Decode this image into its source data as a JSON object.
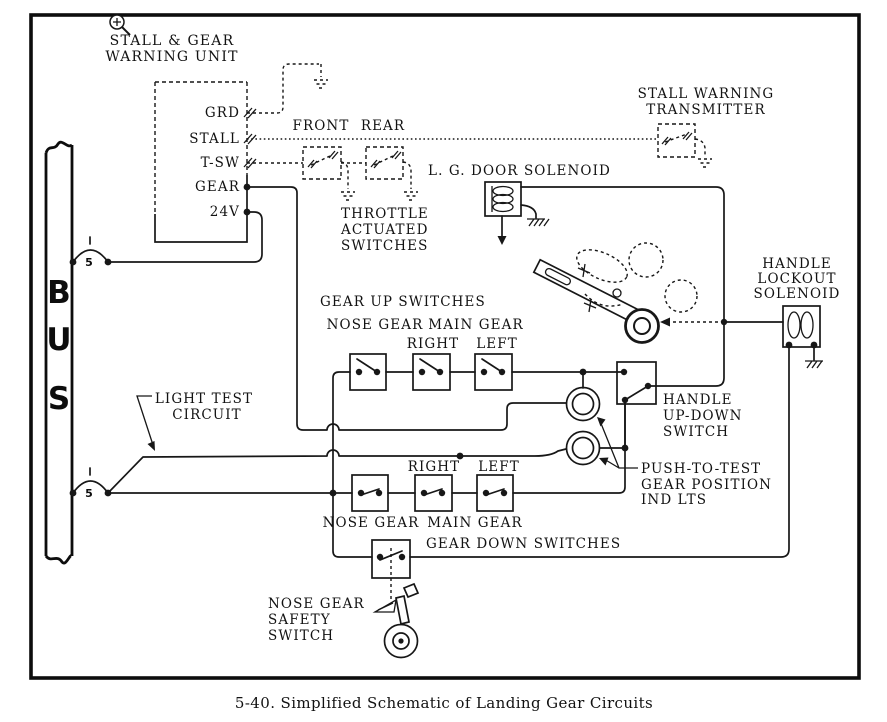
{
  "figure": {
    "caption": "5-40.  Simplified Schematic of Landing Gear Circuits"
  },
  "icons": {
    "magnifier": "circled-plus-with-handle"
  },
  "bus": {
    "name_letters": [
      "B",
      "U",
      "S"
    ],
    "breakers": [
      {
        "rating": "5"
      },
      {
        "rating": "5"
      }
    ]
  },
  "warning_unit": {
    "title": [
      "STALL & GEAR",
      "WARNING UNIT"
    ],
    "terminals": [
      "GRD",
      "STALL",
      "T-SW",
      "GEAR",
      "24V"
    ]
  },
  "throttle_switches": {
    "front_label": "FRONT",
    "rear_label": "REAR",
    "caption": [
      "THROTTLE",
      "ACTUATED",
      "SWITCHES"
    ]
  },
  "stall_transmitter": {
    "label": [
      "STALL WARNING",
      "TRANSMITTER"
    ]
  },
  "door_solenoid": {
    "label": "L. G. DOOR SOLENOID"
  },
  "handle_lockout": {
    "label": [
      "HANDLE",
      "LOCKOUT",
      "SOLENOID"
    ]
  },
  "handle_switch": {
    "label": [
      "HANDLE",
      "UP-DOWN",
      "SWITCH"
    ]
  },
  "gear_up": {
    "title": "GEAR UP SWITCHES",
    "nose": "NOSE GEAR",
    "main": "MAIN GEAR",
    "right": "RIGHT",
    "left": "LEFT"
  },
  "gear_down": {
    "title": "GEAR DOWN SWITCHES",
    "nose": "NOSE GEAR",
    "main": "MAIN GEAR",
    "right": "RIGHT",
    "left": "LEFT"
  },
  "indicator_lights": {
    "label": [
      "PUSH-TO-TEST",
      "GEAR POSITION",
      "IND LTS"
    ]
  },
  "light_test": {
    "label": [
      "LIGHT TEST",
      "CIRCUIT"
    ]
  },
  "safety_switch": {
    "label": [
      "NOSE GEAR",
      "SAFETY",
      "SWITCH"
    ]
  }
}
